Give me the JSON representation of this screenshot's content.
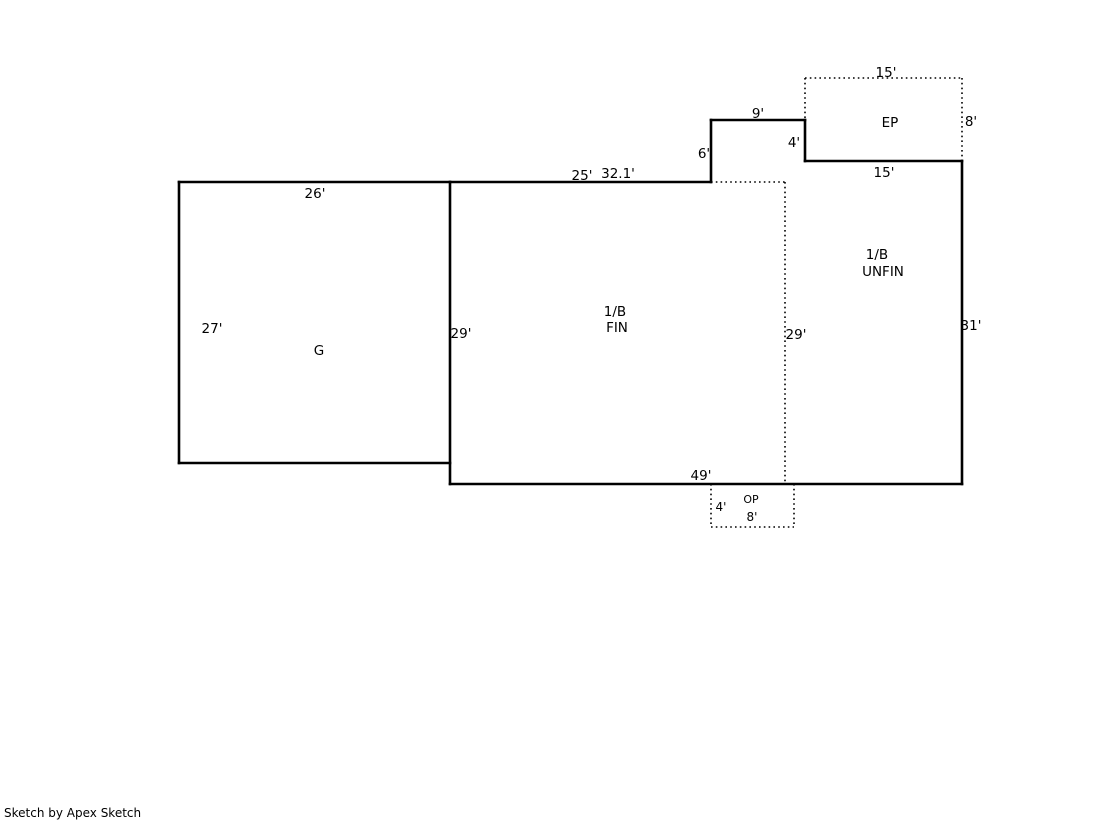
{
  "footer": {
    "credit": "Sketch by Apex Sketch"
  },
  "sketch": {
    "canvas": {
      "width": 1119,
      "height": 821
    },
    "colors": {
      "background": "#ffffff",
      "line": "#000000",
      "text": "#000000"
    },
    "line_styles": {
      "solid_width": 2.6,
      "dotted_width": 1.6,
      "dotted_dash": "1.6 3.2"
    },
    "walls_solid": [
      {
        "name": "garage-top-wall",
        "x1": 179,
        "y1": 182,
        "x2": 450,
        "y2": 182
      },
      {
        "name": "garage-left-wall",
        "x1": 179,
        "y1": 182,
        "x2": 179,
        "y2": 463
      },
      {
        "name": "garage-bottom-wall",
        "x1": 179,
        "y1": 463,
        "x2": 450,
        "y2": 463
      },
      {
        "name": "main-left-wall",
        "x1": 450,
        "y1": 182,
        "x2": 450,
        "y2": 484
      },
      {
        "name": "main-top-wall",
        "x1": 450,
        "y1": 182,
        "x2": 711,
        "y2": 182
      },
      {
        "name": "notch-west-wall",
        "x1": 711,
        "y1": 120,
        "x2": 711,
        "y2": 182
      },
      {
        "name": "notch-north-wall",
        "x1": 711,
        "y1": 120,
        "x2": 805,
        "y2": 120
      },
      {
        "name": "ep-west-lower-wall",
        "x1": 805,
        "y1": 120,
        "x2": 805,
        "y2": 161
      },
      {
        "name": "ep-south-wall",
        "x1": 805,
        "y1": 161,
        "x2": 962,
        "y2": 161
      },
      {
        "name": "main-right-wall",
        "x1": 962,
        "y1": 161,
        "x2": 962,
        "y2": 484
      },
      {
        "name": "main-bottom-wall",
        "x1": 450,
        "y1": 484,
        "x2": 962,
        "y2": 484
      }
    ],
    "walls_dotted": [
      {
        "name": "ep-north-edge",
        "x1": 805,
        "y1": 78,
        "x2": 962,
        "y2": 78
      },
      {
        "name": "ep-west-upper-edge",
        "x1": 805,
        "y1": 78,
        "x2": 805,
        "y2": 120
      },
      {
        "name": "ep-east-edge",
        "x1": 962,
        "y1": 78,
        "x2": 962,
        "y2": 161
      },
      {
        "name": "partition-north-edge",
        "x1": 711,
        "y1": 182,
        "x2": 785,
        "y2": 182
      },
      {
        "name": "partition-east-edge",
        "x1": 785,
        "y1": 182,
        "x2": 785,
        "y2": 484
      },
      {
        "name": "op-west-edge",
        "x1": 711,
        "y1": 484,
        "x2": 711,
        "y2": 527
      },
      {
        "name": "op-south-edge",
        "x1": 711,
        "y1": 527,
        "x2": 794,
        "y2": 527
      },
      {
        "name": "op-east-edge",
        "x1": 794,
        "y1": 484,
        "x2": 794,
        "y2": 527
      }
    ],
    "labels": [
      {
        "name": "dim-garage-width-26",
        "text": "26'",
        "x": 315,
        "y": 198,
        "size": 13.5
      },
      {
        "name": "dim-garage-depth-27",
        "text": "27'",
        "x": 212,
        "y": 333,
        "size": 13.5
      },
      {
        "name": "area-label-garage",
        "text": "G",
        "x": 319,
        "y": 355,
        "size": 13.5
      },
      {
        "name": "dim-main-left-29",
        "text": "29'",
        "x": 461,
        "y": 338,
        "size": 13.5
      },
      {
        "name": "dim-main-top-25",
        "text": "25'",
        "x": 582,
        "y": 180,
        "size": 13.5
      },
      {
        "name": "dim-main-top-32-1",
        "text": "32.1'",
        "x": 618,
        "y": 178,
        "size": 13.5
      },
      {
        "name": "dim-notch-height-6",
        "text": "6'",
        "x": 704,
        "y": 158,
        "size": 13.5
      },
      {
        "name": "dim-notch-width-9",
        "text": "9'",
        "x": 758,
        "y": 118,
        "size": 13.5
      },
      {
        "name": "dim-notch-drop-4",
        "text": "4'",
        "x": 794,
        "y": 147,
        "size": 13.5
      },
      {
        "name": "dim-ep-width-15",
        "text": "15'",
        "x": 886,
        "y": 77,
        "size": 13.5
      },
      {
        "name": "area-label-ep",
        "text": "EP",
        "x": 890,
        "y": 127,
        "size": 13.5
      },
      {
        "name": "dim-ep-height-8",
        "text": "8'",
        "x": 971,
        "y": 126,
        "size": 13.5
      },
      {
        "name": "dim-ep-bottom-15",
        "text": "15'",
        "x": 884,
        "y": 177,
        "size": 13.5
      },
      {
        "name": "area-label-fin-line1",
        "text": "1/B",
        "x": 615,
        "y": 316,
        "size": 13.5
      },
      {
        "name": "area-label-fin-line2",
        "text": "FIN",
        "x": 617,
        "y": 332,
        "size": 13.5
      },
      {
        "name": "dim-partition-29",
        "text": "29'",
        "x": 796,
        "y": 339,
        "size": 13.5
      },
      {
        "name": "area-label-unfin-line1",
        "text": "1/B",
        "x": 877,
        "y": 259,
        "size": 13.5
      },
      {
        "name": "area-label-unfin-line2",
        "text": "UNFIN",
        "x": 883,
        "y": 276,
        "size": 13.5
      },
      {
        "name": "dim-main-right-31",
        "text": "31'",
        "x": 971,
        "y": 330,
        "size": 13.5
      },
      {
        "name": "dim-main-bottom-49",
        "text": "49'",
        "x": 701,
        "y": 480,
        "size": 13.5
      },
      {
        "name": "dim-op-height-4",
        "text": "4'",
        "x": 721,
        "y": 511,
        "size": 12
      },
      {
        "name": "area-label-op",
        "text": "OP",
        "x": 751,
        "y": 503,
        "size": 11
      },
      {
        "name": "dim-op-width-8",
        "text": "8'",
        "x": 752,
        "y": 521,
        "size": 12
      }
    ]
  }
}
